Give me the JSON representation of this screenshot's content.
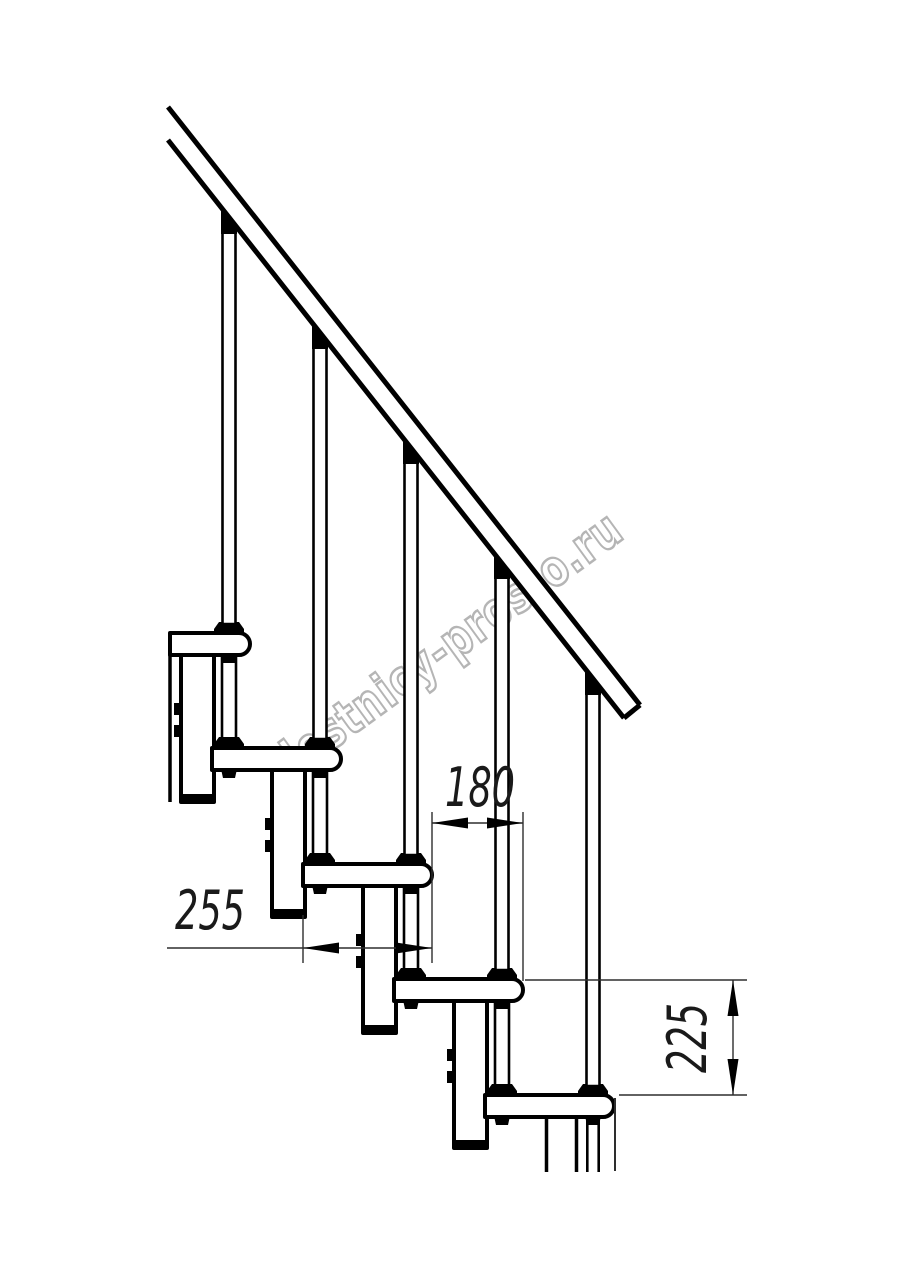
{
  "drawing": {
    "title": "staircase-module-side-elevation",
    "watermark": "lestnicy-prosto.ru",
    "dimensions": {
      "step_run": "180",
      "tread_depth": "255",
      "riser_height": "225"
    },
    "colors": {
      "line": "#000000",
      "dimension_line": "#2e2e2e",
      "watermark": "#b5b5b5",
      "background": "#ffffff"
    }
  }
}
